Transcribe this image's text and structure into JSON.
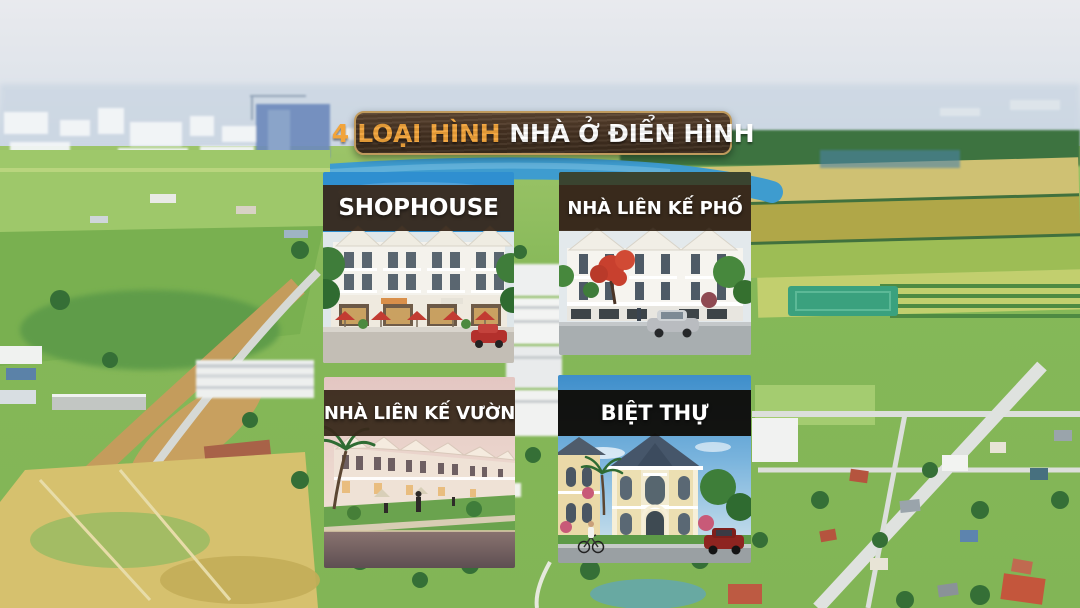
{
  "banner": {
    "highlight": "4 LOẠI HÌNH",
    "rest": "NHÀ Ở ĐIỂN HÌNH",
    "bg_color": "#47331f",
    "border_color": "#bf9a5d",
    "highlight_color": "#f2a43b",
    "text_color": "#ffffff"
  },
  "cards": [
    {
      "id": "shophouse",
      "label": "SHOPHOUSE",
      "band_color": "#39291b"
    },
    {
      "id": "nha-lien-ke-pho",
      "label": "NHÀ LIÊN KẾ PHỐ",
      "band_color": "#39291b"
    },
    {
      "id": "nha-lien-ke-vuon",
      "label": "NHÀ LIÊN KẾ VƯỜN",
      "band_color": "#39291b"
    },
    {
      "id": "biet-thu",
      "label": "BIỆT THỰ",
      "band_color": "#0f0c08"
    }
  ]
}
